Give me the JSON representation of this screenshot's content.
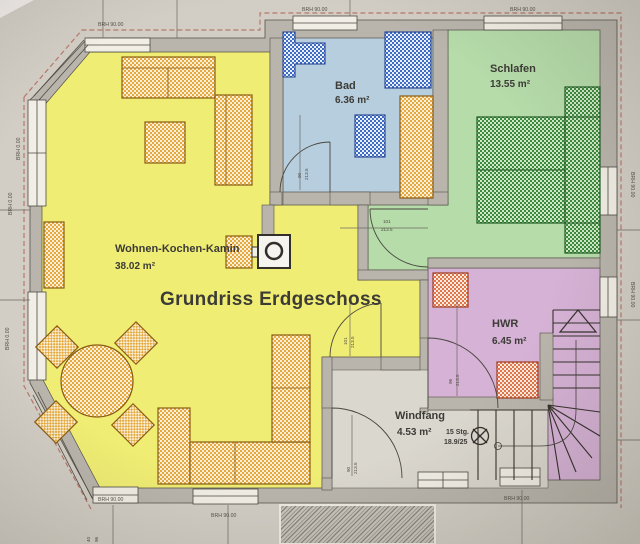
{
  "title": "Grundriss Erdgeschoss",
  "rooms": {
    "wohnen": {
      "name": "Wohnen-Kochen-Kamin",
      "area": "38.02 m²"
    },
    "bad": {
      "name": "Bad",
      "area": "6.36 m²"
    },
    "schlafen": {
      "name": "Schlafen",
      "area": "13.55 m²"
    },
    "hwr": {
      "name": "HWR",
      "area": "6.45 m²"
    },
    "windfang": {
      "name": "Windfang",
      "area": "4.53 m²"
    }
  },
  "stairs": {
    "count_label": "15 Stg.",
    "ratio_label": "18.9/25"
  },
  "sills": {
    "high": "BRH 90.00",
    "floor": "BRH 0.00"
  },
  "dims": {
    "h2135": "213.5",
    "w101": "101",
    "w96": "96",
    "w90": "90",
    "w40": "40"
  },
  "colors": {
    "paper": "#d2cec5",
    "wall": "#b9b5ac",
    "wohnen": "#f0ed74",
    "bad": "#b7cedf",
    "fixture_blue": "#3f6cc4",
    "schlafen": "#b6dcaa",
    "bed_green": "#3c8a3e",
    "hwr": "#d6b2d6",
    "windfang_floor": "#dad7ce",
    "furniture_orange": "#e5a93f",
    "appliance_orange": "#e0764a",
    "accent_red": "#cf4426",
    "roof_dash": "#b4685a"
  }
}
